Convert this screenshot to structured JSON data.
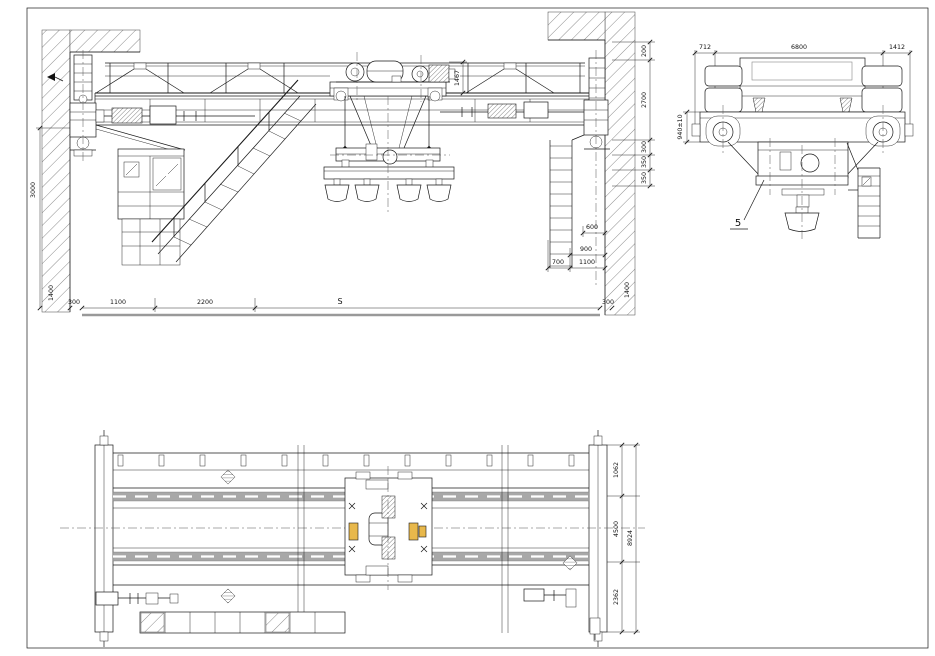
{
  "drawing": {
    "type": "overhead-crane-general-arrangement",
    "colors": {
      "line": "#1a1a1a",
      "floor_line": "#999999",
      "rail_band": "#a8a8a8",
      "highlight": "#e8b84b"
    },
    "front_view": {
      "dim_wall_height": "3000",
      "dim_trolley_height": "1467",
      "dim_right_top": "200",
      "dim_right_wall": "2700",
      "dim_right_a": "300",
      "dim_right_b": "350",
      "dim_right_c": "350",
      "dim_hook_a": "600",
      "dim_hook_b": "900",
      "dim_hook_c": "700",
      "dim_hook_d": "1100",
      "dim_floor_left_offset": "300",
      "dim_rail_left": "1400",
      "dim_cab_a": "1100",
      "dim_cab_b": "2200",
      "dim_span": "S",
      "dim_floor_right_offset": "300",
      "dim_rail_right": "1400"
    },
    "end_view": {
      "dim_left_overhang": "712",
      "dim_width": "6800",
      "dim_right_overhang": "1412",
      "dim_wheel_height": "940±10",
      "callout_magnet": "5"
    },
    "plan_view": {
      "dim_walkway": "1062",
      "dim_rail_gauge": "4500",
      "dim_overall_width": "8924",
      "dim_lower": "2362"
    }
  }
}
